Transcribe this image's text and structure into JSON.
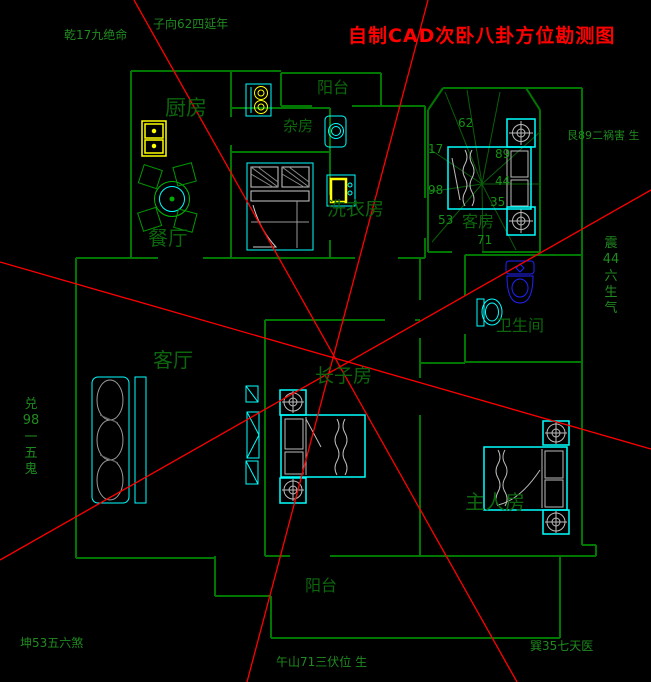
{
  "title": "自制CAD次卧八卦方位勘测图",
  "annotations": {
    "qian_top_left": "乾17九绝命",
    "zi_top": "子向62四延年",
    "gen_right_top": "艮89二祸害 生",
    "zhen_right_vertical": "震\n44\n六\n生\n气",
    "dui_left_vertical": "兑\n98\n一\n五\n鬼",
    "kun_bottom_left": "坤53五六煞",
    "wu_bottom_center": "午山71三伏位 生",
    "xun_bottom_right": "巽35七天医"
  },
  "rooms": {
    "kitchen": "厨房",
    "dining": "餐厅",
    "utility": "杂房",
    "balcony_top": "阳台",
    "laundry": "洗衣房",
    "guest": "客房",
    "bathroom": "卫生间",
    "living": "客厅",
    "eldest_son": "长子房",
    "master": "主人房",
    "balcony_bottom": "阳台"
  },
  "bagua_numbers": [
    "62",
    "17",
    "98",
    "53",
    "71",
    "89",
    "44",
    "35"
  ],
  "colors": {
    "background": "#000000",
    "walls": "#007700",
    "furniture_cyan": "#00ffff",
    "fixtures_yellow": "#ffff00",
    "toilet_blue": "#2222ff",
    "survey_line_red": "#ff0000",
    "label_green": "#0d660d"
  }
}
